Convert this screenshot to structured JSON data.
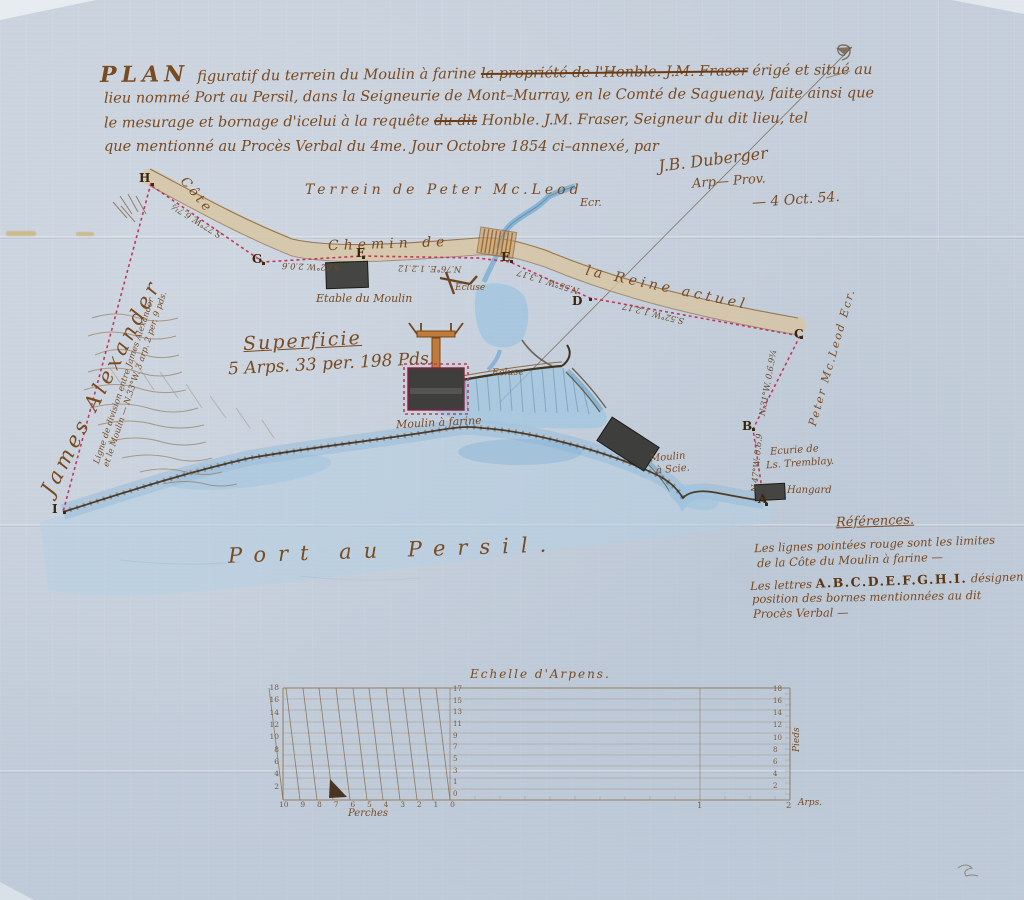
{
  "title": {
    "plan_word": "PLAN",
    "line1_pre": "figuratif du terrein du Moulin à farine ",
    "line1_struck": "la propriété de l'Honble. J.M. Fraser",
    "line1_post": " érigé et situé au",
    "line2": "lieu nommé Port au Persil, dans la Seigneurie de Mont–Murray, en le Comté de Saguenay, faite ainsi que",
    "line3_pre": "le mesurage et bornage d'icelui à la requête ",
    "line3_struck": "du dit",
    "line3_post": " Honble. J.M. Fraser, Seigneur du dit lieu, tel",
    "line4": "que mentionné au Procès Verbal du 4me. Jour Octobre 1854 ci–annexé, par",
    "sig_name": "J.B. Duberger",
    "sig_title": "Arp— Prov.",
    "sig_date": "— 4 Oct. 54."
  },
  "map": {
    "terrain_top": "Terrein de Peter Mc.Leod",
    "terrain_top_esq": "Ecr.",
    "neighbor_left": "James Alexander",
    "neighbor_right": "Peter Mc.Leod Ecr.",
    "cote": "Côte",
    "chemin": "Chemin de",
    "reine": "la Reine actuel",
    "bay": "Port au Persil.",
    "superficie": "Superficie",
    "superficie_value": "5 Arps. 33 per. 198 Pds.",
    "etable": "Etable du Moulin",
    "moulin_farine": "Moulin à farine",
    "ecluse_upper": "Ecluse",
    "ecluse_lower": "Ecluse",
    "moulin_scie_1": "Moulin",
    "moulin_scie_2": "à Scie.",
    "hangard": "Hangard",
    "ecurie_1": "Ecurie de",
    "ecurie_2": "Ls. Tremblay.",
    "division_1": "Ligne de division entre James Alexander",
    "division_2": "et le Moulin — N.33°W. 3 arp. 2 per. 9 pds.",
    "markers": {
      "a": "A",
      "b": "B",
      "c": "C",
      "d": "D",
      "e": "E",
      "f": "F",
      "g": "G",
      "h": "H",
      "i": "I"
    },
    "meas": {
      "hg": "S.77°W. 6.7½",
      "gf": "S.82°W. 2.0.6",
      "fe": "N.76°E. 1.2.12",
      "ed": "N.55°W. 1.3.17",
      "dc": "S.52°W. 1.2.17",
      "cb": "N.31°W. 0.6.9¾",
      "ba": "N.47°W. 0.6.9"
    }
  },
  "references": {
    "title": "Références.",
    "line1": "Les lignes pointées rouge sont les limites",
    "line2": "de la Côte du Moulin à farine —",
    "line3_pre": "Les lettres ",
    "line3_letters": "A.B.C.D.E.F.G.H.I.",
    "line3_post": " désignent la",
    "line4": "position des bornes mentionnées au dit",
    "line5": "Procès Verbal —"
  },
  "scale": {
    "title": "Echelle d'Arpens.",
    "left_ticks": [
      "18",
      "16",
      "14",
      "12",
      "10",
      "8",
      "6",
      "4",
      "2"
    ],
    "bottom_ticks": [
      "10",
      "9",
      "8",
      "7",
      "6",
      "5",
      "4",
      "3",
      "2",
      "1",
      "0"
    ],
    "middle_ticks": [
      "17",
      "15",
      "13",
      "11",
      "9",
      "7",
      "5",
      "3",
      "1",
      "0"
    ],
    "right_ticks": [
      "18",
      "16",
      "14",
      "12",
      "10",
      "8",
      "6",
      "4",
      "2"
    ],
    "perches": "Perches",
    "pieds": "Pieds",
    "one": "1",
    "two": "2",
    "arp": "Arps."
  },
  "colors": {
    "ink": "#7a4a20",
    "red_boundary": "#c13a5e",
    "water": "#9ec4e0",
    "road": "#d9c6a2"
  }
}
